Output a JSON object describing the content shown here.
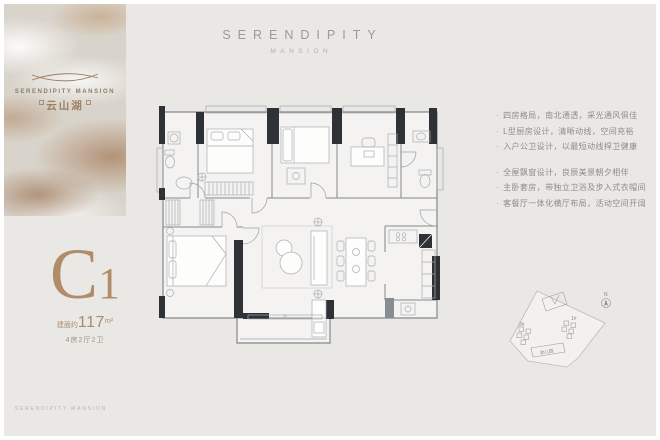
{
  "brand": {
    "panel_title": "SERENDIPITY MANSION",
    "panel_title_cn": "云山湖",
    "footer_text": "SERENDIPITY MANSION"
  },
  "header": {
    "title": "SERENDIPITY",
    "subtitle": "MANSION"
  },
  "unit": {
    "code_main": "C",
    "code_sub": "1",
    "area_prefix": "建面约",
    "area_value": "117",
    "area_unit": "m²",
    "rooms": "4房2厅2卫"
  },
  "features": {
    "bullet": "·",
    "group1": [
      "四房格局，南北通透，采光通风俱佳",
      "L型厨房设计，清晰动线，空间充裕",
      "入户公卫设计，以最短动线捍卫健康"
    ],
    "group2": [
      "全屋飘窗设计，良辰美景朝夕相伴",
      "主卧套房，带独立卫浴及步入式衣帽间",
      "客餐厅一体化横厅布局，活动空间开阔"
    ]
  },
  "siteplan": {
    "north": "N",
    "building_3": "3#",
    "building_1": "1#",
    "kindergarten": "幼儿园"
  },
  "colors": {
    "accent_bronze": "#b08c68",
    "background_gray": "#e9e8e5"
  }
}
